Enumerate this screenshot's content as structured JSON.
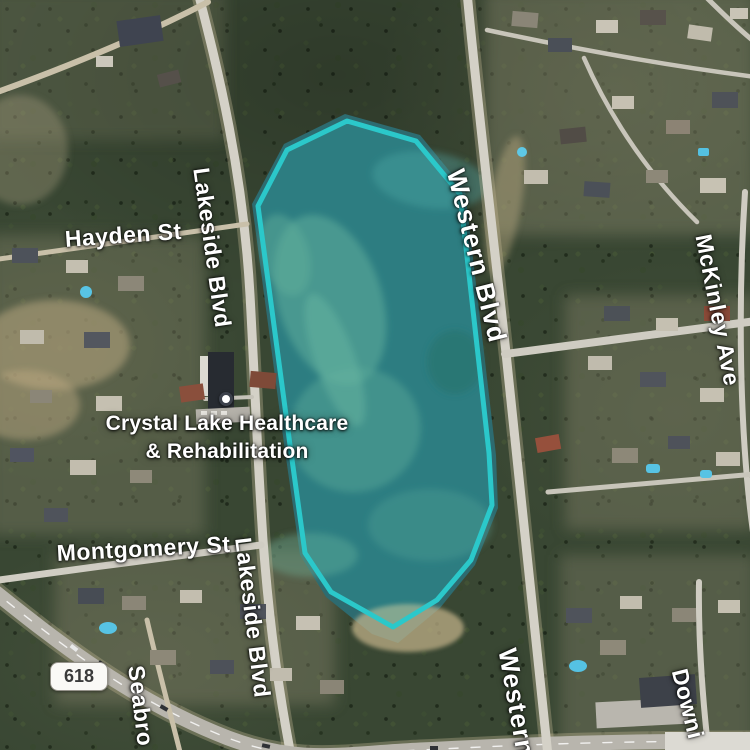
{
  "map": {
    "poi": {
      "name_line1": "Crystal Lake Healthcare",
      "name_line2": "& Rehabilitation"
    },
    "route_shield": "618",
    "streets": {
      "hayden": "Hayden St",
      "lakeside_north": "Lakeside Blvd",
      "lakeside_south": "Lakeside Blvd",
      "western_north": "Western Blvd",
      "western_south": "Western",
      "mckinley": "McKinley Ave",
      "montgomery": "Montgomery St",
      "seabrook": "Seabro",
      "downing": "Downi"
    },
    "highlight_polygon": {
      "stroke_color": "#2bc8ca",
      "fill_color": "rgba(43,200,202,0.20)"
    },
    "colors": {
      "water": "#2d6b70",
      "forest": "#394733",
      "road": "#d4d1c7",
      "sand": "#c4b28a"
    }
  }
}
